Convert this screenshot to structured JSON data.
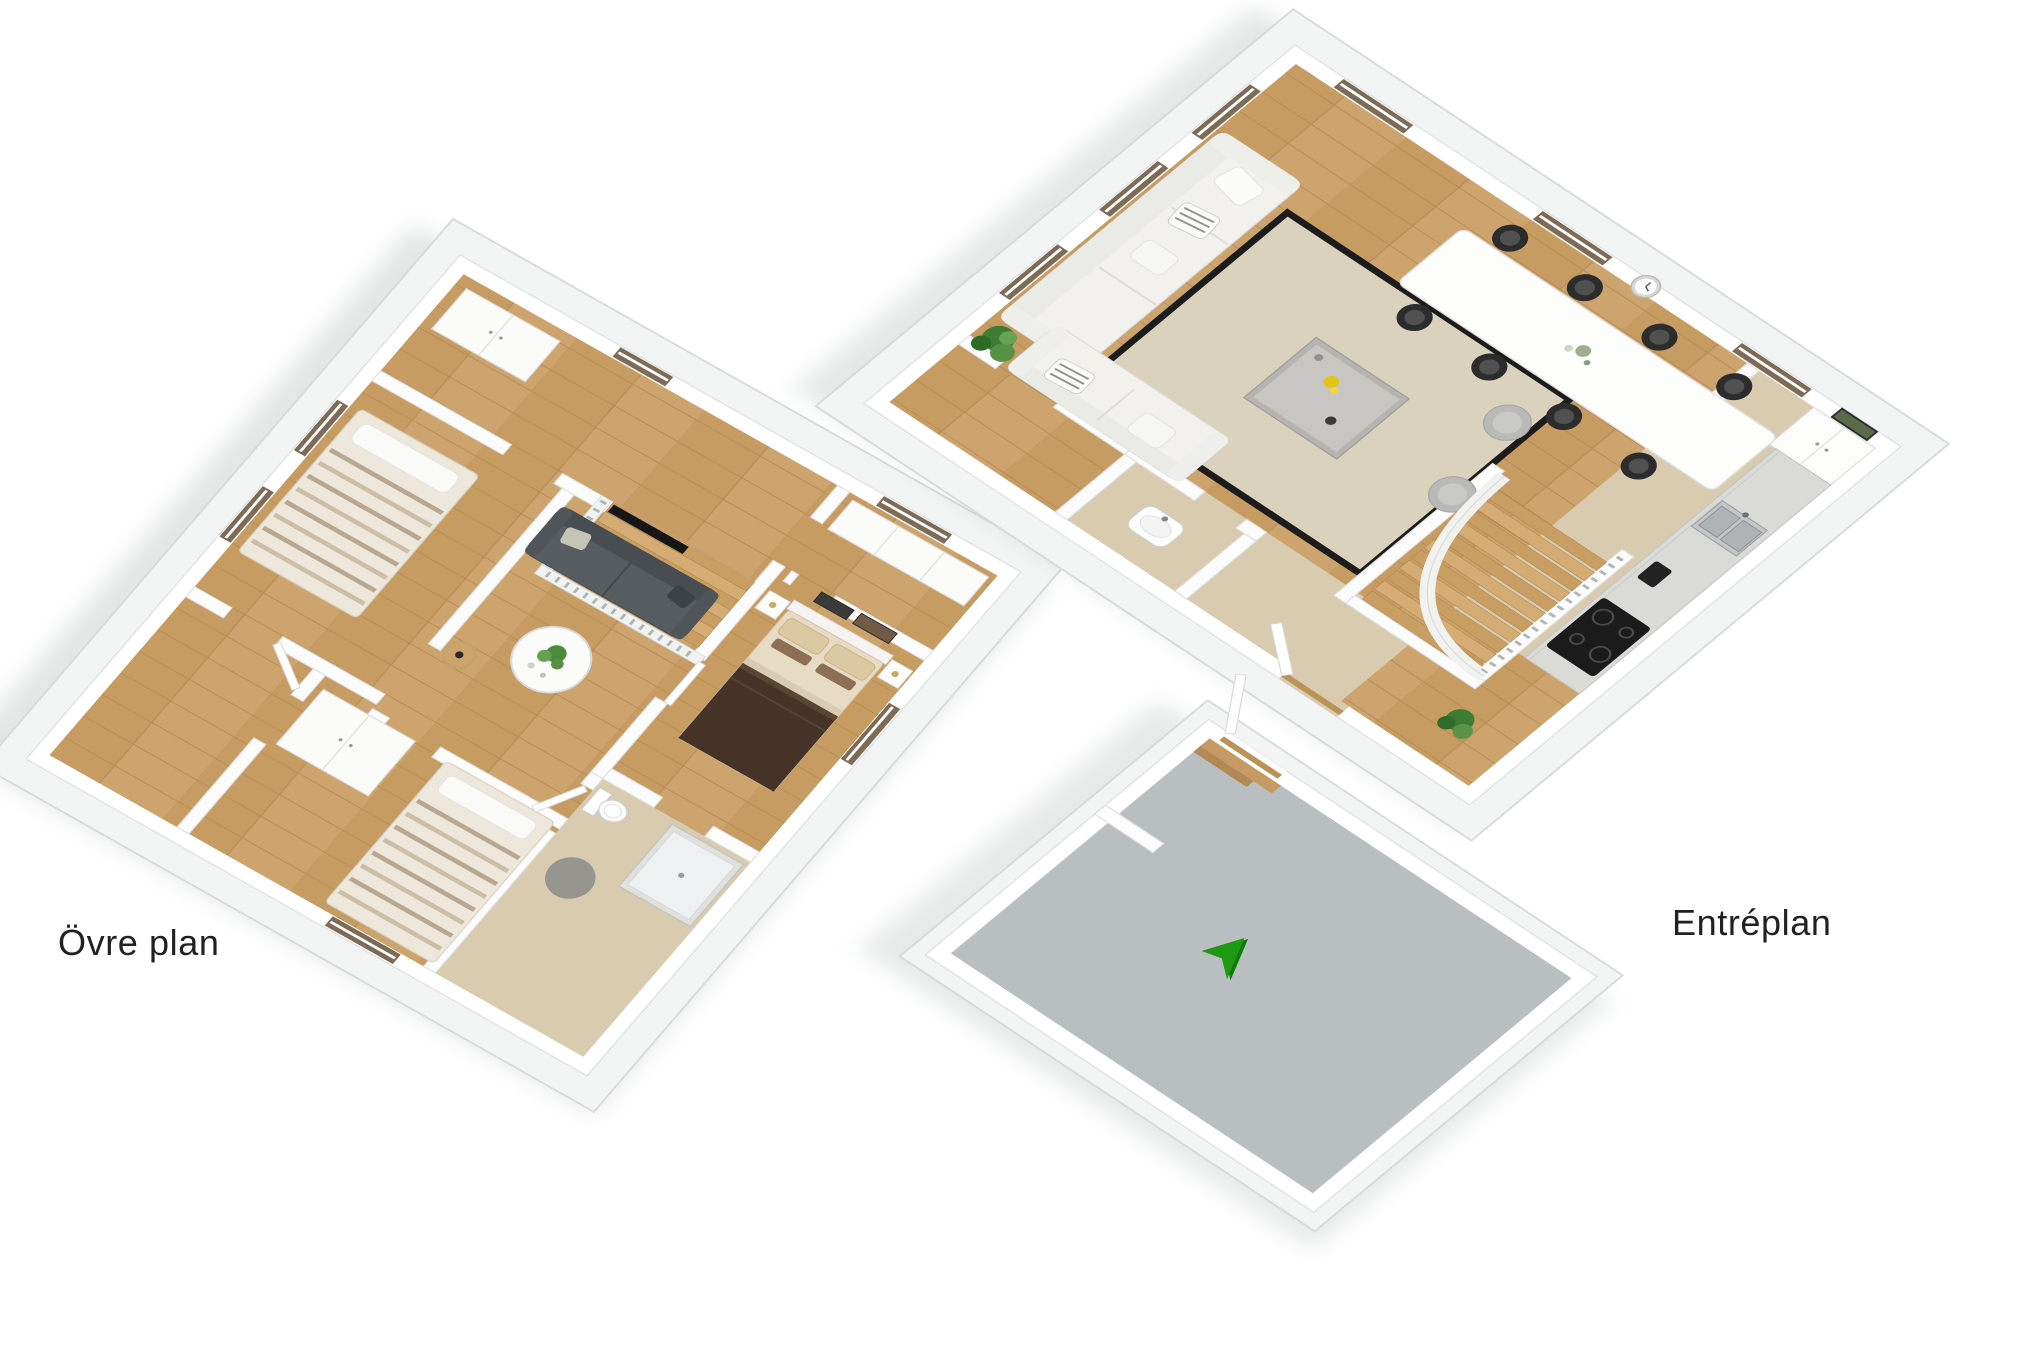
{
  "page": {
    "width": 2043,
    "height": 1365,
    "background": "#ffffff",
    "description": "3D dollhouse-view floor plans of a two-storey home"
  },
  "floor_plans": [
    {
      "id": "ovre-plan",
      "label": "Övre plan",
      "rooms": [
        {
          "name": "landing",
          "furniture": [
            "staircase",
            "railing-balusters",
            "wardrobe"
          ]
        },
        {
          "name": "bedroom-west",
          "furniture": [
            "double-bed-striped",
            "windows"
          ]
        },
        {
          "name": "living-room",
          "furniture": [
            "dark-gray-sofa",
            "throw-pillows",
            "round-white-coffee-table",
            "potted-plant",
            "floor-lamp",
            "wall-tv"
          ]
        },
        {
          "name": "walk-in-closet",
          "furniture": [
            "white-cabinets"
          ]
        },
        {
          "name": "master-bedroom",
          "furniture": [
            "double-bed-brown",
            "nightstands",
            "wall-art",
            "table-lamp"
          ]
        },
        {
          "name": "bathroom",
          "furniture": [
            "toilet",
            "shower-cabin",
            "round-gray-rug"
          ]
        },
        {
          "name": "bedroom-south",
          "furniture": [
            "bed-striped",
            "wardrobes"
          ]
        },
        {
          "name": "hall",
          "furniture": []
        }
      ]
    },
    {
      "id": "entreplan",
      "label": "Entréplan",
      "rooms": [
        {
          "name": "living-room",
          "furniture": [
            "white-sofa",
            "corner-sofa",
            "striped-pillows",
            "beige-area-rug",
            "marble-coffee-table",
            "yellow-flowers",
            "potted-plant",
            "pouf",
            "pouf"
          ]
        },
        {
          "name": "dining-area",
          "furniture": [
            "white-dining-table",
            "black-chair-1",
            "black-chair-2",
            "black-chair-3",
            "black-chair-4",
            "black-chair-5",
            "black-chair-6",
            "black-chair-7",
            "black-chair-8",
            "wall-clock",
            "flower-vase"
          ]
        },
        {
          "name": "kitchen",
          "furniture": [
            "refrigerator-cabinets",
            "counter",
            "double-sink",
            "faucet",
            "coffee-maker",
            "cooktop",
            "wall-art"
          ]
        },
        {
          "name": "staircase",
          "furniture": [
            "winder-stairs",
            "curved-railing",
            "balusters",
            "potted-plant"
          ]
        },
        {
          "name": "bathroom",
          "furniture": [
            "washbasin"
          ]
        },
        {
          "name": "hall",
          "furniture": [
            "entrance-door"
          ]
        },
        {
          "name": "entry-porch",
          "furniture": [
            "open-door",
            "wood-threshold"
          ]
        }
      ],
      "entrance_arrow": {
        "glyph": "➤",
        "color": "#1d9a12",
        "direction": "up-right"
      }
    }
  ],
  "colors": {
    "background": "#ffffff",
    "wall": "#ffffff",
    "wall_edge": "#e2e3e3",
    "slab": "#f3f4f4",
    "slab_edge": "#d9dbdb",
    "wood_floor": "#cda46e",
    "beige_floor": "#d8cbb0",
    "porch_floor": "#b9bec0",
    "rug_beige": "#dbd2bd",
    "rug_border": "#1c1c1c",
    "window_sill": "#7d6b57",
    "dark_sofa": "#575c60",
    "white_sofa": "#f2f1ee",
    "chair_black": "#2c2c2c",
    "bed_brown": "#453327",
    "bedding_beige": "#e7dbc4",
    "arrow_green": "#1d9a12",
    "label_text": "#212121"
  }
}
